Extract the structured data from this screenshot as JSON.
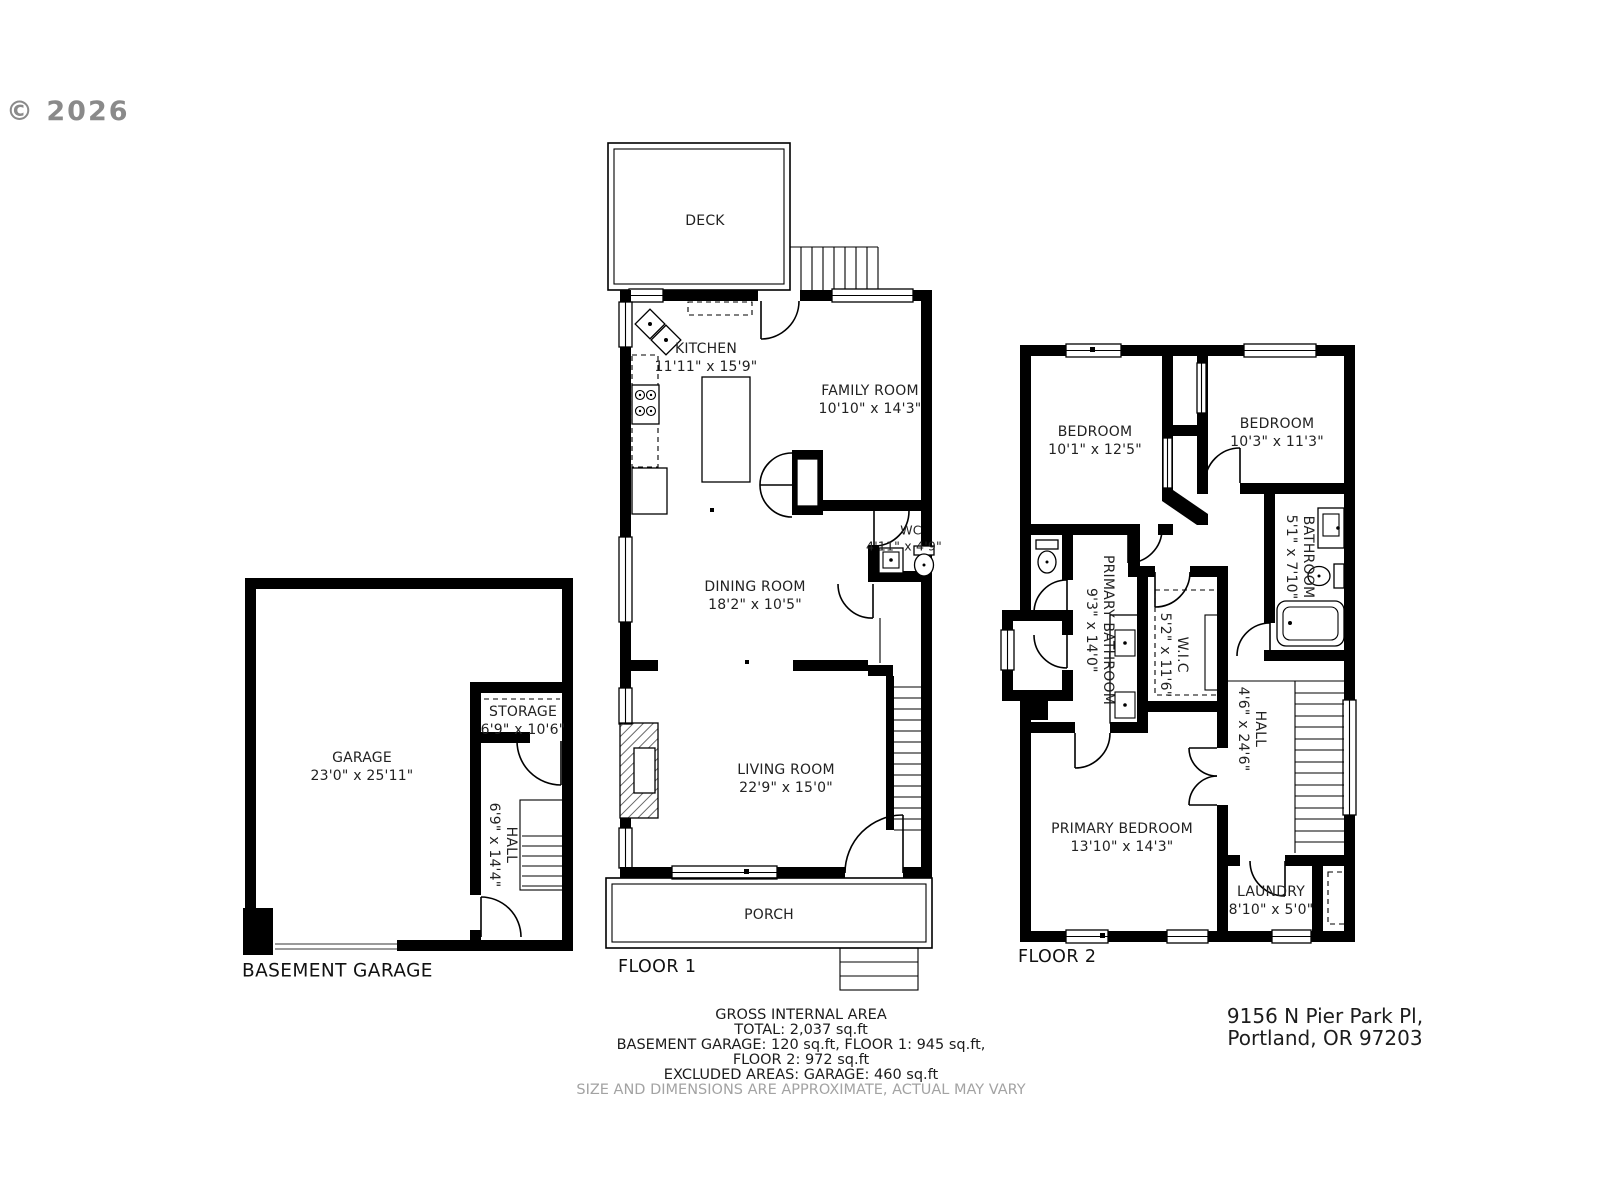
{
  "watermark": "© 2026",
  "plans": {
    "basement": {
      "label": "BASEMENT GARAGE",
      "rooms": {
        "garage": {
          "name": "GARAGE",
          "dims": "23'0\" x 25'11\""
        },
        "storage": {
          "name": "STORAGE",
          "dims": "6'9\" x 10'6\""
        },
        "hall": {
          "name": "HALL",
          "dims": "6'9\" x 14'4\""
        }
      }
    },
    "floor1": {
      "label": "FLOOR 1",
      "rooms": {
        "deck": {
          "name": "DECK",
          "dims": ""
        },
        "kitchen": {
          "name": "KITCHEN",
          "dims": "11'11\" x 15'9\""
        },
        "family_room": {
          "name": "FAMILY ROOM",
          "dims": "10'10\" x 14'3\""
        },
        "wc": {
          "name": "WC",
          "dims": "4'11\" x 4'9\""
        },
        "dining_room": {
          "name": "DINING ROOM",
          "dims": "18'2\" x 10'5\""
        },
        "living_room": {
          "name": "LIVING ROOM",
          "dims": "22'9\" x 15'0\""
        },
        "porch": {
          "name": "PORCH",
          "dims": ""
        }
      }
    },
    "floor2": {
      "label": "FLOOR 2",
      "rooms": {
        "bedroom_left": {
          "name": "BEDROOM",
          "dims": "10'1\" x 12'5\""
        },
        "bedroom_right": {
          "name": "BEDROOM",
          "dims": "10'3\" x 11'3\""
        },
        "bathroom": {
          "name": "BATHROOM",
          "dims": "5'1\" x 7'10\""
        },
        "primary_bathroom": {
          "name": "PRIMARY BATHROOM",
          "dims": "9'3\" x 14'0\""
        },
        "wic": {
          "name": "W.I.C",
          "dims": "5'2\" x 11'6\""
        },
        "hall": {
          "name": "HALL",
          "dims": "4'6\" x 24'6\""
        },
        "primary_bedroom": {
          "name": "PRIMARY BEDROOM",
          "dims": "13'10\" x 14'3\""
        },
        "laundry": {
          "name": "LAUNDRY",
          "dims": "8'10\" x 5'0\""
        }
      }
    }
  },
  "footer": {
    "title": "GROSS INTERNAL AREA",
    "total": "TOTAL: 2,037 sq.ft",
    "breakdown1": "BASEMENT GARAGE: 120 sq.ft, FLOOR 1: 945 sq.ft,",
    "breakdown2": "FLOOR 2: 972 sq.ft",
    "excluded": "EXCLUDED AREAS: GARAGE: 460 sq.ft",
    "disclaimer": "SIZE AND DIMENSIONS ARE APPROXIMATE, ACTUAL MAY VARY"
  },
  "address": {
    "line1": "9156 N Pier Park Pl,",
    "line2": "Portland, OR 97203"
  }
}
